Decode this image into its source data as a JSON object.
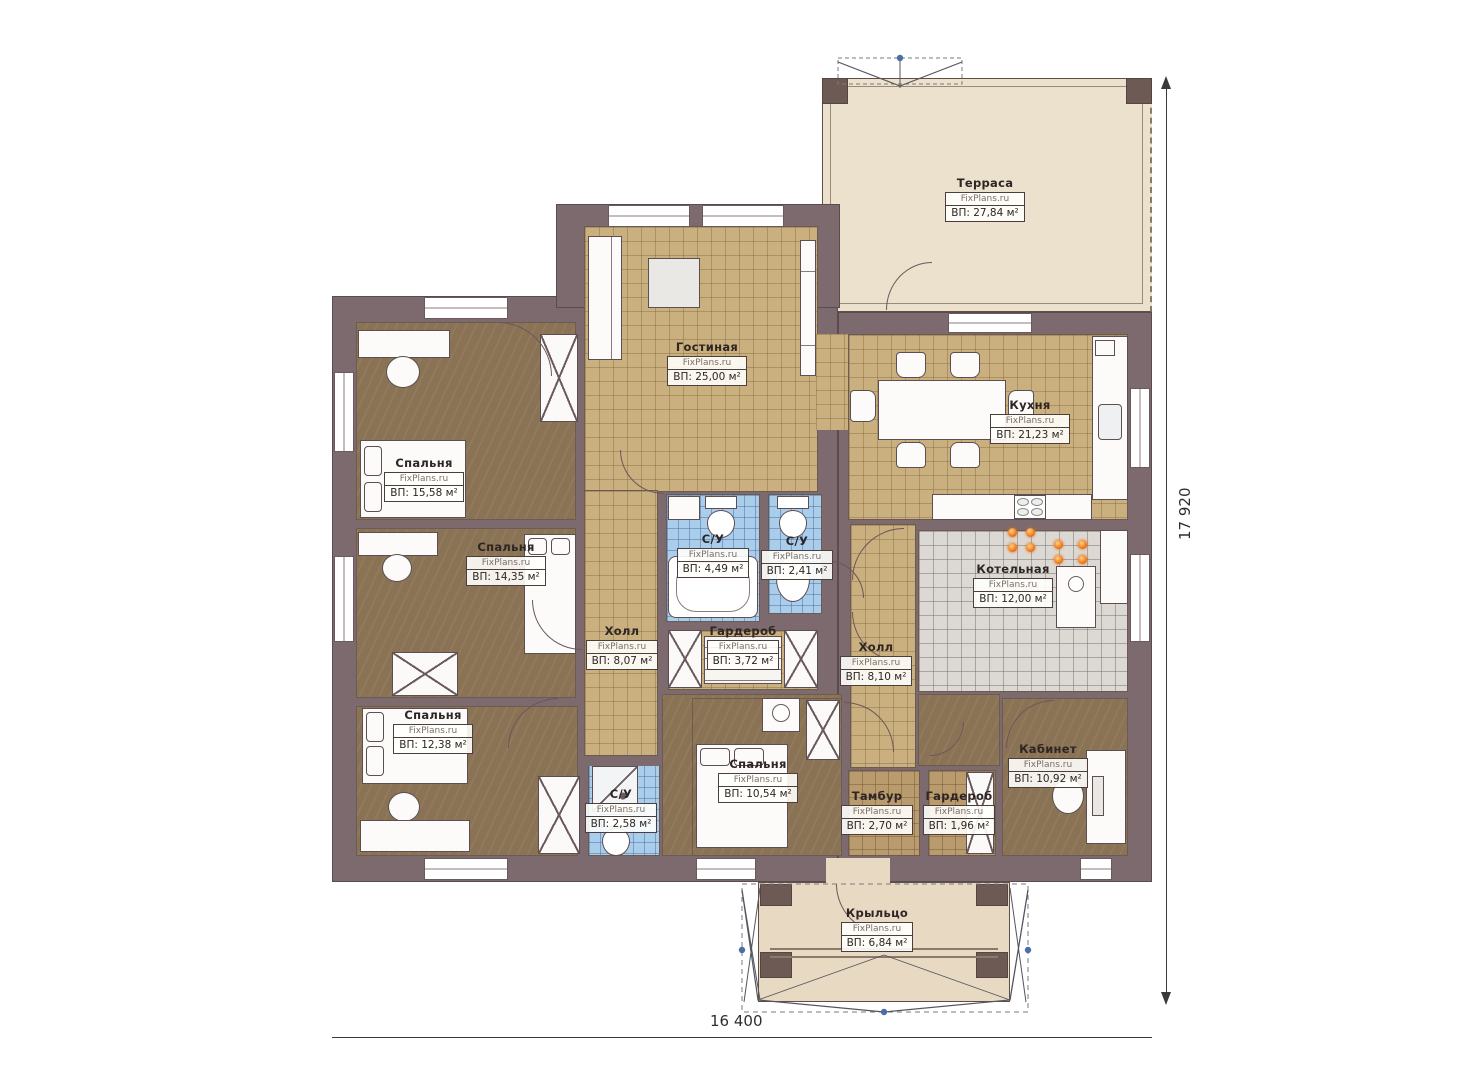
{
  "meta": {
    "watermark": "FixPlans.ru",
    "width_label": "16 400",
    "height_label": "17 920"
  },
  "rooms": [
    {
      "name": "Терраса",
      "area": "ВП: 27,84 м²"
    },
    {
      "name": "Гостиная",
      "area": "ВП: 25,00 м²"
    },
    {
      "name": "Кухня",
      "area": "ВП: 21,23 м²"
    },
    {
      "name": "Спальня",
      "area": "ВП: 15,58 м²"
    },
    {
      "name": "Спальня",
      "area": "ВП: 14,35 м²"
    },
    {
      "name": "С/У",
      "area": "ВП: 4,49 м²"
    },
    {
      "name": "С/У",
      "area": "ВП: 2,41 м²"
    },
    {
      "name": "Холл",
      "area": "ВП: 8,07 м²"
    },
    {
      "name": "Гардероб",
      "area": "ВП: 3,72 м²"
    },
    {
      "name": "Холл",
      "area": "ВП: 8,10 м²"
    },
    {
      "name": "Котельная",
      "area": "ВП: 12,00 м²"
    },
    {
      "name": "Спальня",
      "area": "ВП: 12,38 м²"
    },
    {
      "name": "С/У",
      "area": "ВП: 2,58 м²"
    },
    {
      "name": "Спальня",
      "area": "ВП: 10,54 м²"
    },
    {
      "name": "Тамбур",
      "area": "ВП: 2,70 м²"
    },
    {
      "name": "Гардероб",
      "area": "ВП: 1,96 м²"
    },
    {
      "name": "Кабинет",
      "area": "ВП: 10,92 м²"
    },
    {
      "name": "Крыльцо",
      "area": "ВП: 6,84 м²"
    }
  ],
  "colors": {
    "wall": "#7d6a6e",
    "tile_floor": "#cab07f",
    "wood_floor": "#8a7254",
    "bath_floor": "#abcdec",
    "boiler_floor": "#dcd9d5",
    "deck_floor": "#ebe1cc",
    "burner_orange": "#f07818",
    "dimension_node_blue": "#4a6fa5"
  }
}
